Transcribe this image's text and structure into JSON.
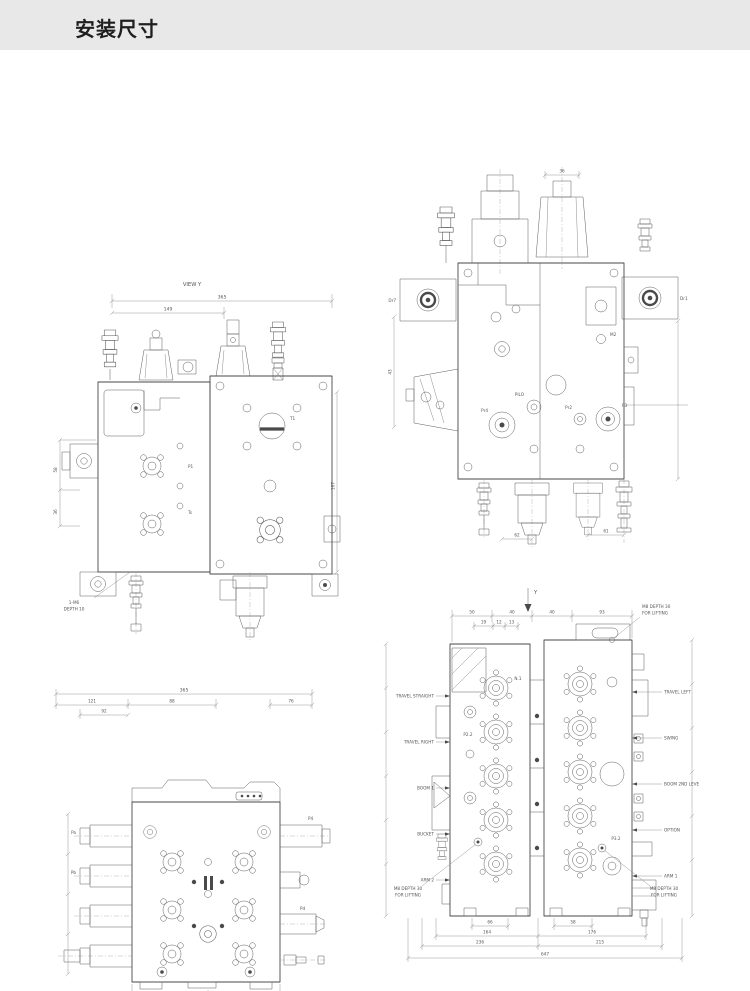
{
  "header": {
    "title": "安装尺寸"
  },
  "colors": {
    "band_bg": "#e8e8e8",
    "line": "#474747",
    "dim_line": "#8c8c8c"
  },
  "d1": {
    "view": "VIEW Y",
    "note1": "1-M6",
    "note2": "DEPTH 10",
    "ports": {
      "p1": "P1",
      "t1": "T1",
      "ts": "Ts"
    },
    "dims": {
      "w": "365",
      "w2": "149",
      "h1": "58",
      "h2": "36",
      "hr": "167"
    }
  },
  "d2": {
    "ports": {
      "dr7": "Dr7",
      "dr1": "Dr1",
      "m2": "M2",
      "pilo": "PiLO",
      "pr4": "Pr4",
      "pr2": "Pr2",
      "p3": "P3"
    },
    "dims": {
      "top": "36",
      "left": "43",
      "b1": "62",
      "b2": "61"
    }
  },
  "d3": {
    "ports": {
      "pa": "Pa",
      "pb": "Pb",
      "p4": "P4",
      "pd": "Pd"
    },
    "dims": {
      "w": "365",
      "t1": "121",
      "t2": "88",
      "t3": "76",
      "t4": "92",
      "b1": "56",
      "b2": "88"
    }
  },
  "d4": {
    "view": "Y",
    "labels_left": [
      "TRAVEL STRAIGHT",
      "TRAVEL RIGHT",
      "BOOM 1",
      "BUCKET",
      "ARM 2"
    ],
    "labels_right": [
      "TRAVEL LEFT",
      "SWING",
      "BOOM 2ND LEVE",
      "OPTION",
      "ARM 1"
    ],
    "note1": "M8 DEPTH 30",
    "note2": "FOR LIFTING",
    "ports": {
      "p22": "P2.2",
      "n1": "N.1",
      "p32": "P3.2"
    },
    "dims_top": [
      "50",
      "40",
      "40",
      "93"
    ],
    "dims_top2": [
      "19",
      "12",
      "13"
    ],
    "dims_bottom": {
      "a": "66",
      "b": "58",
      "c": "164",
      "d": "176",
      "e": "236",
      "f": "215",
      "g": "647"
    }
  }
}
